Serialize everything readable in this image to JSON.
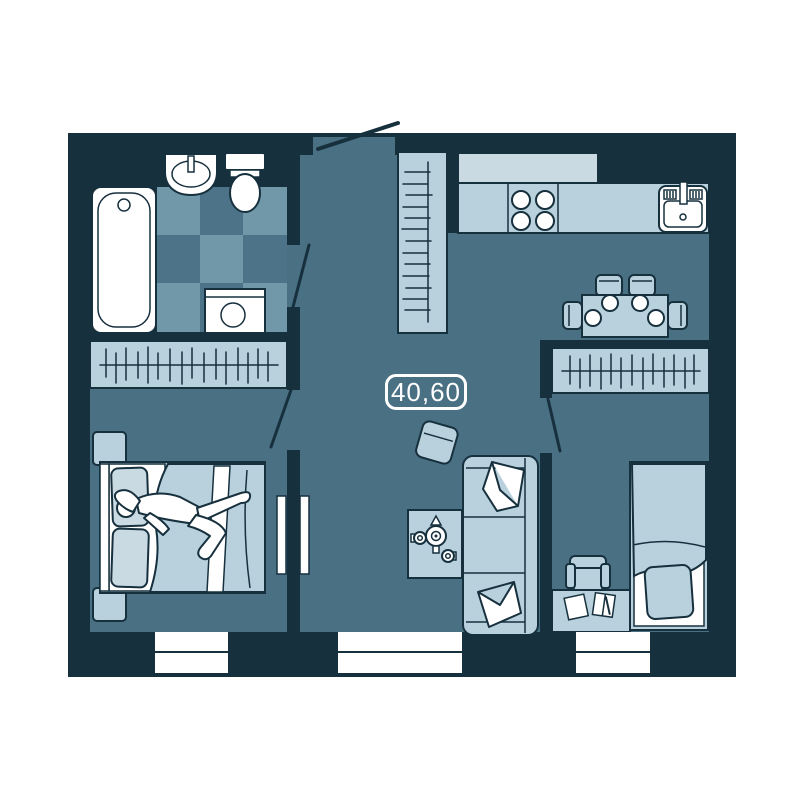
{
  "floorplan": {
    "area_label": "40,60",
    "colors": {
      "background": "#ffffff",
      "wall": "#17303e",
      "outline": "#17303e",
      "floor": "#4a7084",
      "furniture": "#b8d1dc",
      "furniture_light": "#c9dae3",
      "tile_dark": "#4d7389",
      "tile_light": "#7198a8",
      "white": "#ffffff"
    },
    "icons": [
      "bathtub-icon",
      "washbasin-icon",
      "toilet-icon",
      "washing-machine-icon",
      "wardrobe-icon",
      "hanger-rail-icon",
      "entry-door-icon",
      "door-swing-icon",
      "kitchen-upper-cabinets-icon",
      "kitchen-counter-icon",
      "stove-icon",
      "kitchen-sink-icon",
      "dining-table-icon",
      "dining-chair-icon",
      "plate-icon",
      "armchair-icon",
      "coffee-table-icon",
      "teapot-icon",
      "teacup-icon",
      "sofa-icon",
      "sofa-pillow-icon",
      "interior-double-door-icon",
      "nightstand-icon",
      "double-bed-icon",
      "bed-pillow-icon",
      "person-figure",
      "single-bed-icon",
      "desk-icon",
      "paper-icon",
      "desk-chair-icon",
      "window-icon"
    ]
  }
}
